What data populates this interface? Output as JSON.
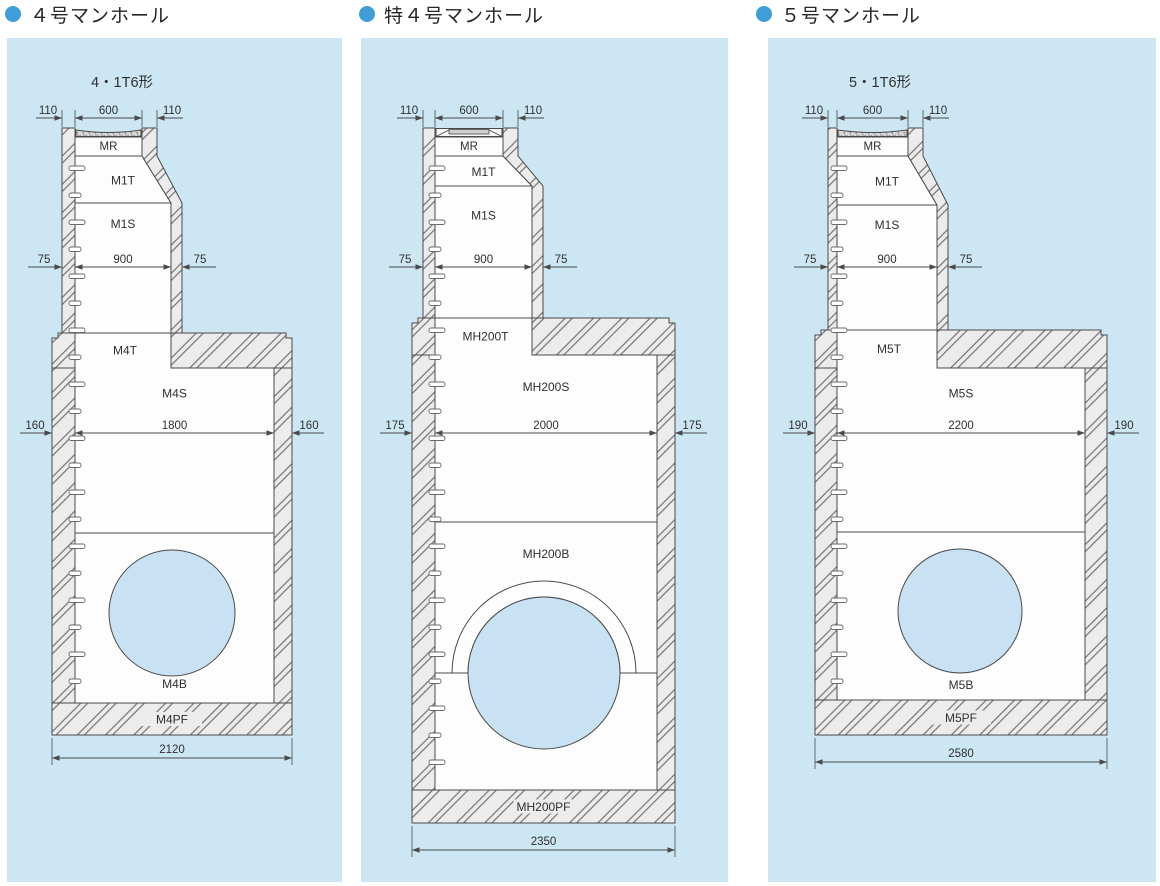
{
  "page": {
    "background": "#ffffff"
  },
  "colors": {
    "panel_bg": "#cde6f4",
    "bullet": "#3f9ed8",
    "line": "#4a4a4a",
    "wall_fill": "#ececec",
    "hatch_line": "#737373",
    "pipe_fill": "#c8e2f3",
    "lid_fill": "#d8d8d8",
    "text": "#2f2f2f"
  },
  "panels": [
    {
      "title": "４号マンホール",
      "model": "4・1T6形",
      "top_dims": {
        "left": "110",
        "center": "600",
        "right": "110"
      },
      "shaft_dims": {
        "left": "75",
        "center": "900",
        "right": "75"
      },
      "chamber_dims": {
        "left": "160",
        "center": "1800",
        "right": "160"
      },
      "overall_dim": "2120",
      "parts": {
        "ring": "MR",
        "taper": "M1T",
        "shaft": "M1S",
        "chamber_top": "M4T",
        "chamber_mid": "M4S",
        "chamber_bottom": "M4B",
        "footing": "M4PF"
      }
    },
    {
      "title": "特４号マンホール",
      "model": "",
      "top_dims": {
        "left": "110",
        "center": "600",
        "right": "110"
      },
      "shaft_dims": {
        "left": "75",
        "center": "900",
        "right": "75"
      },
      "chamber_dims": {
        "left": "175",
        "center": "2000",
        "right": "175"
      },
      "overall_dim": "2350",
      "parts": {
        "ring": "MR",
        "taper": "M1T",
        "shaft": "M1S",
        "chamber_top": "MH200T",
        "chamber_mid": "MH200S",
        "chamber_bottom": "MH200B",
        "footing": "MH200PF"
      }
    },
    {
      "title": "５号マンホール",
      "model": "5・1T6形",
      "top_dims": {
        "left": "110",
        "center": "600",
        "right": "110"
      },
      "shaft_dims": {
        "left": "75",
        "center": "900",
        "right": "75"
      },
      "chamber_dims": {
        "left": "190",
        "center": "2200",
        "right": "190"
      },
      "overall_dim": "2580",
      "parts": {
        "ring": "MR",
        "taper": "M1T",
        "shaft": "M1S",
        "chamber_top": "M5T",
        "chamber_mid": "M5S",
        "chamber_bottom": "M5B",
        "footing": "M5PF"
      }
    }
  ]
}
